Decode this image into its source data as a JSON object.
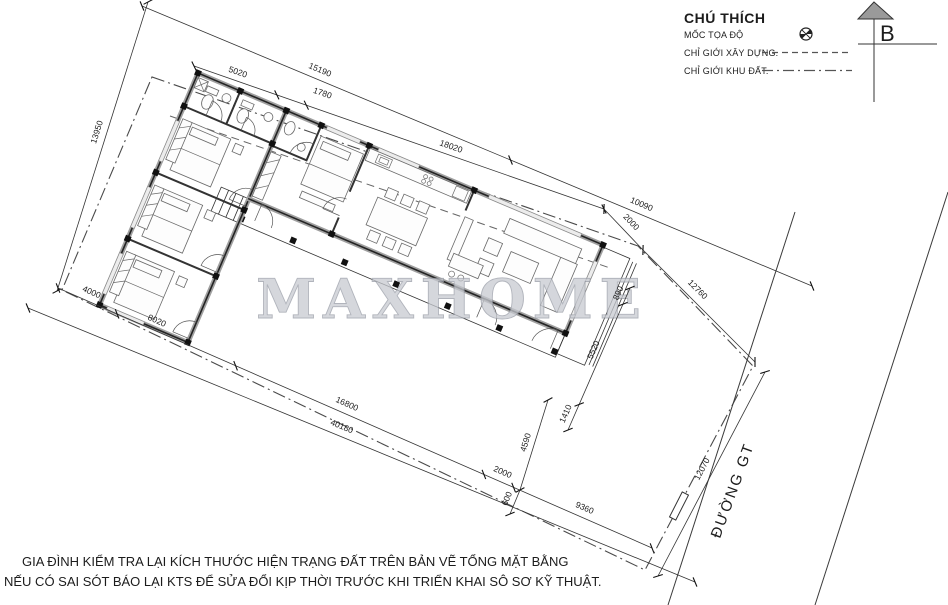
{
  "legend": {
    "title": "CHÚ THÍCH",
    "items": [
      {
        "label": "MỐC TỌA ĐỘ",
        "symbol": "survey-marker"
      },
      {
        "label": "CHỈ GIỚI XÂY DỰNG.",
        "symbol": "dashed-line"
      },
      {
        "label": "CHỈ GIỚI KHU ĐẤT.",
        "symbol": "dash-dot-line"
      }
    ]
  },
  "north_arrow": {
    "label": "B"
  },
  "watermark": {
    "text": "MAXHOME"
  },
  "road": {
    "label": "ĐƯỜNG GT"
  },
  "notes": {
    "line1": "GIA ĐÌNH KIỂM TRA LẠI KÍCH THƯỚC HIỆN TRẠNG  ĐẤT TRÊN BẢN VẼ TỔNG MẶT BẰNG",
    "line2": "NẾU CÓ SAI SÓT BÁO LẠI KTS  ĐỂ SỬA ĐỔI KỊP THỜI TRƯỚC KHI TRIỂN KHAI SÔ SƠ KỸ THUẬT."
  },
  "dimensions": {
    "top_outer": [
      "15190",
      "10090"
    ],
    "top_inner": [
      "5020",
      "1780",
      "18020"
    ],
    "top_gap": "2000",
    "right_upper": "12760",
    "left": "13950",
    "bottom_outer": "40180",
    "bottom_inner": [
      "4000",
      "8020",
      "16800",
      "2000",
      "9360"
    ],
    "house_right": [
      "890",
      "5520",
      "1410"
    ],
    "gap_bottom": [
      "4590",
      "600"
    ],
    "road_side": "12070"
  },
  "colors": {
    "wall": "#242424",
    "wall_fill": "#a0a0a0",
    "boundary": "#4a4a4a",
    "watermark": "#c7cad1"
  }
}
